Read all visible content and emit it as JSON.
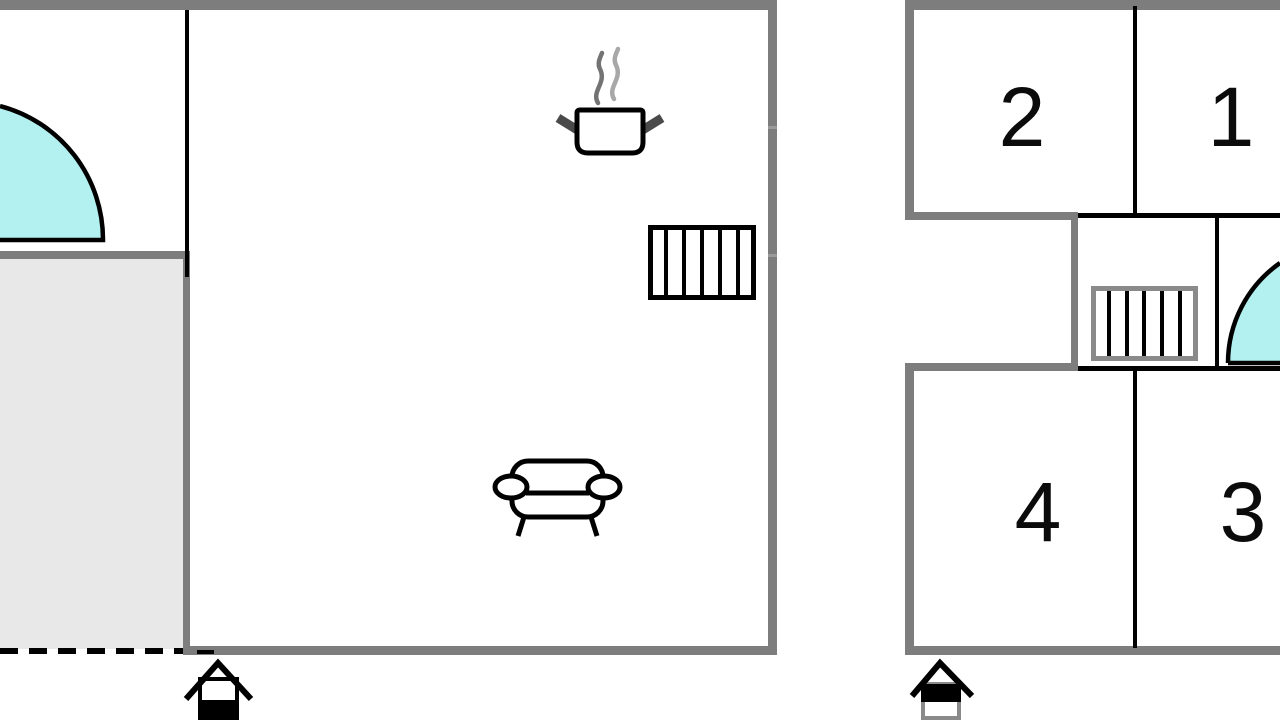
{
  "plan": {
    "kind": "house floor plan",
    "colors": {
      "wall": "#7d7d7d",
      "room_line": "#000000",
      "door_swing_fill": "#b3f1f1",
      "terrace_fill": "#e8e8e8",
      "stair_border_upper": "#8a8a8a"
    },
    "ground_floor": {
      "name": "ground-floor",
      "icons": [
        "door-swing",
        "cooking-pot",
        "stairs",
        "sofa",
        "house-level-indicator-lower-filled"
      ]
    },
    "upper_floor": {
      "name": "upper-floor",
      "rooms": [
        {
          "label": "2",
          "position": "top-left"
        },
        {
          "label": "1",
          "position": "top-right"
        },
        {
          "label": "4",
          "position": "bottom-left"
        },
        {
          "label": "3",
          "position": "bottom-right"
        }
      ],
      "icons": [
        "stairs",
        "door-swing",
        "house-level-indicator-upper-filled"
      ]
    }
  }
}
